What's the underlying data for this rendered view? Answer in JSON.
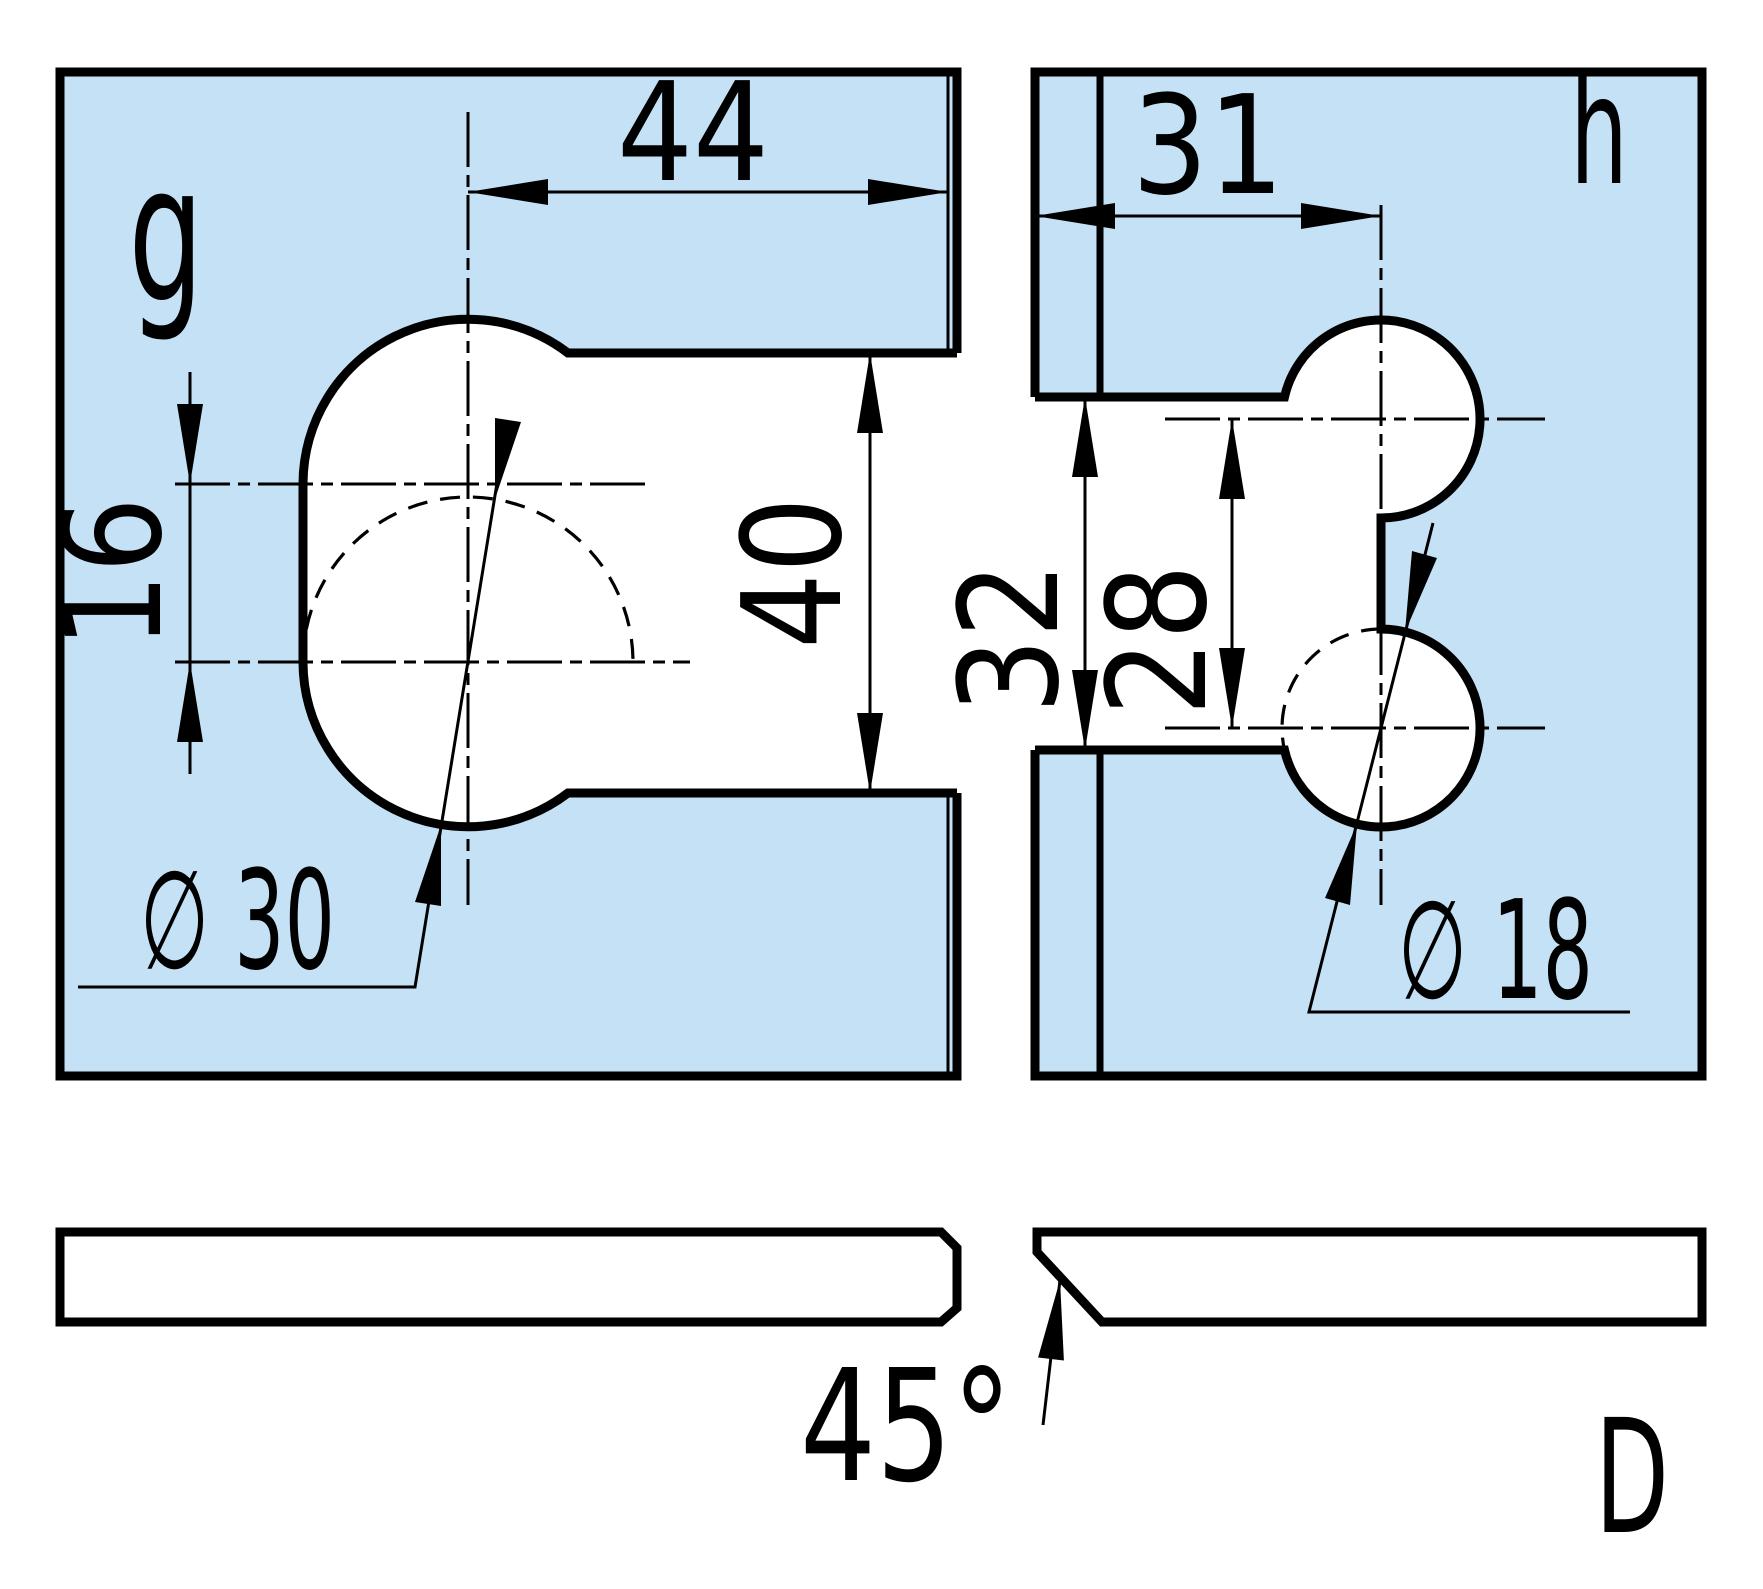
{
  "drawing": {
    "views": {
      "plan_left_label": "g",
      "plan_right_label": "h",
      "sheet_label": "D"
    },
    "dimensions": {
      "width_top_left": "44",
      "center_offset_left": "16",
      "notch_height_left": "40",
      "diameter_left": "∅ 30",
      "edge_offset_right": "31",
      "notch_height_right": "32",
      "center_distance_right": "28",
      "diameter_right": "∅ 18",
      "chamfer_angle": "45°"
    },
    "colors": {
      "part_fill": "#c4e1f6",
      "line": "#000000",
      "background": "#ffffff"
    }
  }
}
